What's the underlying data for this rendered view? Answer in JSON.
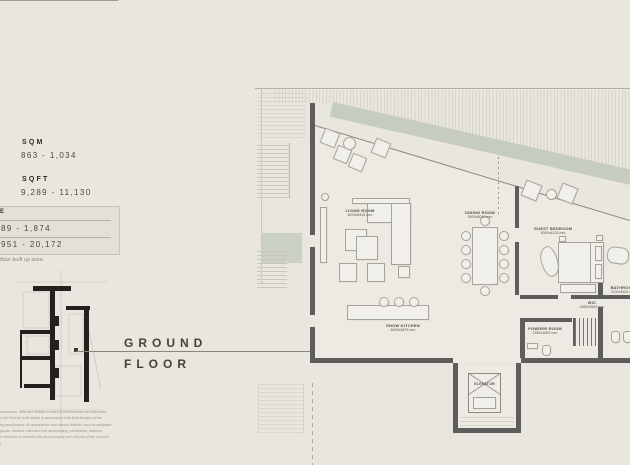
{
  "panel": {
    "sqm_label": "SQM",
    "sqm_value": "863 - 1,034",
    "sqft_label": "SQFT",
    "sqft_value": "9,289 - 11,130",
    "area_box": {
      "heading_fragment": "E",
      "row1": "89 - 1,874",
      "row2": "951 - 20,172"
    },
    "footnote": "floor built up area.",
    "floor_word1": "GROUND",
    "floor_word2": "FLOOR",
    "disclaimer_lines": [
      "nformation, data and details included in this brochure are indicative",
      "o the final 'as built' status in accordance with final designs of the",
      "ng permissions. All accessories and interior finishes such as wallpaper,",
      "goods, curtains, hard and soft landscaping, pavements, features,",
      "e brochure or between the plot boundary, are not part of the unit and",
      ")"
    ]
  },
  "plan": {
    "rooms": [
      {
        "name": "LIVING ROOM",
        "dims": "8200x8415 mm"
      },
      {
        "name": "DINING ROOM",
        "dims": "5500x5040 mm"
      },
      {
        "name": "GUEST BEDROOM",
        "dims": "5000x4125 mm"
      },
      {
        "name": "BATHROOM",
        "dims": "2100x4625 mm"
      },
      {
        "name": "WIC",
        "dims": "1850x2500 mm"
      },
      {
        "name": "SHOW KITCHEN",
        "dims": "8400x3875 mm"
      },
      {
        "name": "POWDER ROOM",
        "dims": "2950x1600 mm"
      },
      {
        "name": "ELEVATOR",
        "dims": ""
      }
    ]
  },
  "colors": {
    "background": "#e9e6df",
    "wall": "#5d5d5b",
    "sage_band": "#c7ccc0",
    "interior_floor": "#edeae3"
  }
}
